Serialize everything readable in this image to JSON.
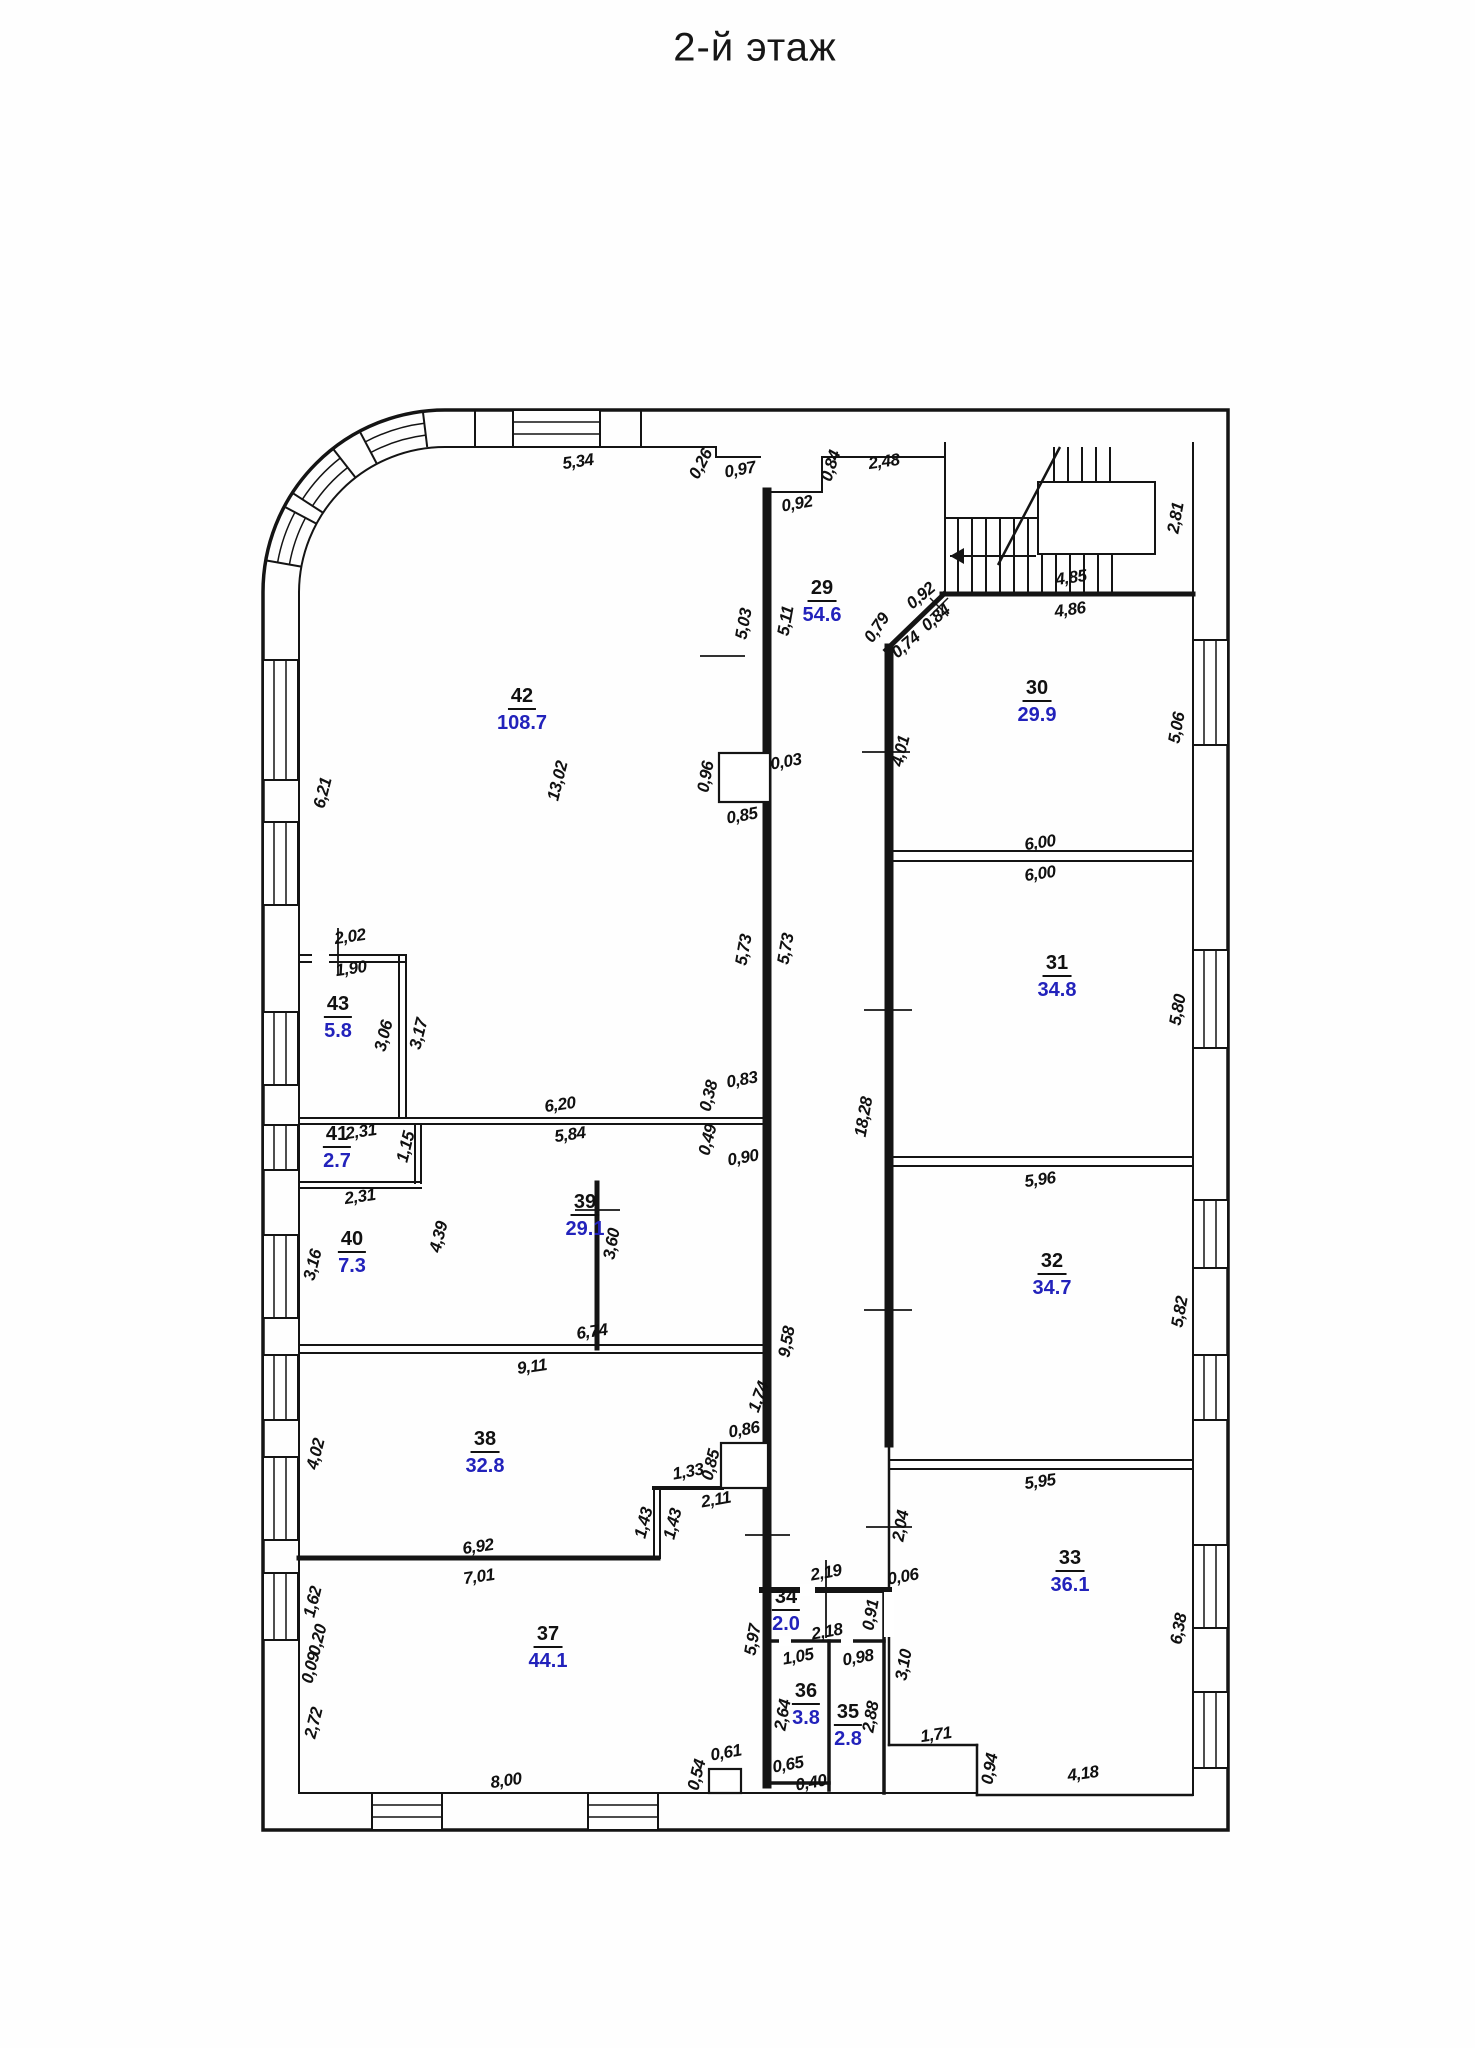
{
  "title": "2-й этаж",
  "colors": {
    "line": "#141414",
    "area_text": "#2222bb",
    "dim_text": "#101010"
  },
  "plan": {
    "rooms": [
      {
        "num": "29",
        "area": "54.6",
        "x": 822,
        "y": 592
      },
      {
        "num": "30",
        "area": "29.9",
        "x": 1037,
        "y": 692
      },
      {
        "num": "31",
        "area": "34.8",
        "x": 1057,
        "y": 967
      },
      {
        "num": "32",
        "area": "34.7",
        "x": 1052,
        "y": 1265
      },
      {
        "num": "33",
        "area": "36.1",
        "x": 1070,
        "y": 1562
      },
      {
        "num": "34",
        "area": "2.0",
        "x": 786,
        "y": 1601
      },
      {
        "num": "35",
        "area": "2.8",
        "x": 848,
        "y": 1716
      },
      {
        "num": "36",
        "area": "3.8",
        "x": 806,
        "y": 1695
      },
      {
        "num": "37",
        "area": "44.1",
        "x": 548,
        "y": 1638
      },
      {
        "num": "38",
        "area": "32.8",
        "x": 485,
        "y": 1443
      },
      {
        "num": "39",
        "area": "29.1",
        "x": 585,
        "y": 1206
      },
      {
        "num": "40",
        "area": "7.3",
        "x": 352,
        "y": 1243
      },
      {
        "num": "41",
        "area": "2.7",
        "x": 337,
        "y": 1138
      },
      {
        "num": "42",
        "area": "108.7",
        "x": 522,
        "y": 700
      },
      {
        "num": "43",
        "area": "5.8",
        "x": 338,
        "y": 1008
      }
    ],
    "dims": [
      {
        "t": "5,34",
        "x": 578,
        "y": 462,
        "r": -8
      },
      {
        "t": "0,26",
        "x": 701,
        "y": 464,
        "r": -62
      },
      {
        "t": "0,97",
        "x": 740,
        "y": 470,
        "r": -10
      },
      {
        "t": "0,92",
        "x": 797,
        "y": 504,
        "r": -10
      },
      {
        "t": "0,84",
        "x": 831,
        "y": 466,
        "r": -72
      },
      {
        "t": "2,48",
        "x": 884,
        "y": 462,
        "r": -8
      },
      {
        "t": "0,92",
        "x": 921,
        "y": 596,
        "r": -40
      },
      {
        "t": "0,79",
        "x": 877,
        "y": 628,
        "r": -56
      },
      {
        "t": "0,74",
        "x": 906,
        "y": 645,
        "r": -40
      },
      {
        "t": "0,84",
        "x": 936,
        "y": 618,
        "r": -40
      },
      {
        "t": "4,85",
        "x": 1071,
        "y": 578,
        "r": -8
      },
      {
        "t": "4,86",
        "x": 1070,
        "y": 610,
        "r": -8
      },
      {
        "t": "2,81",
        "x": 1176,
        "y": 518,
        "r": -80
      },
      {
        "t": "5,03",
        "x": 744,
        "y": 624,
        "r": -80
      },
      {
        "t": "5,11",
        "x": 786,
        "y": 621,
        "r": -80
      },
      {
        "t": "0,96",
        "x": 706,
        "y": 777,
        "r": -80
      },
      {
        "t": "0,03",
        "x": 786,
        "y": 762,
        "r": -10
      },
      {
        "t": "0,85",
        "x": 742,
        "y": 816,
        "r": -10
      },
      {
        "t": "6,21",
        "x": 323,
        "y": 793,
        "r": -76
      },
      {
        "t": "13,02",
        "x": 558,
        "y": 781,
        "r": -76
      },
      {
        "t": "4,01",
        "x": 901,
        "y": 751,
        "r": -76
      },
      {
        "t": "5,06",
        "x": 1177,
        "y": 728,
        "r": -80
      },
      {
        "t": "6,00",
        "x": 1040,
        "y": 843,
        "r": -8
      },
      {
        "t": "6,00",
        "x": 1040,
        "y": 874,
        "r": -8
      },
      {
        "t": "5,73",
        "x": 744,
        "y": 950,
        "r": -80
      },
      {
        "t": "5,73",
        "x": 786,
        "y": 949,
        "r": -80
      },
      {
        "t": "18,28",
        "x": 864,
        "y": 1117,
        "r": -80
      },
      {
        "t": "5,80",
        "x": 1178,
        "y": 1010,
        "r": -80
      },
      {
        "t": "2,02",
        "x": 350,
        "y": 937,
        "r": -8
      },
      {
        "t": "1,90",
        "x": 351,
        "y": 969,
        "r": -8
      },
      {
        "t": "3,06",
        "x": 384,
        "y": 1036,
        "r": -76
      },
      {
        "t": "3,17",
        "x": 419,
        "y": 1034,
        "r": -76
      },
      {
        "t": "6,20",
        "x": 560,
        "y": 1105,
        "r": -8
      },
      {
        "t": "5,84",
        "x": 570,
        "y": 1135,
        "r": -8
      },
      {
        "t": "0,83",
        "x": 742,
        "y": 1080,
        "r": -10
      },
      {
        "t": "0,38",
        "x": 709,
        "y": 1096,
        "r": -76
      },
      {
        "t": "0,49",
        "x": 708,
        "y": 1140,
        "r": -76
      },
      {
        "t": "0,90",
        "x": 743,
        "y": 1158,
        "r": -10
      },
      {
        "t": "2,31",
        "x": 361,
        "y": 1132,
        "r": -8
      },
      {
        "t": "1,15",
        "x": 406,
        "y": 1147,
        "r": -76
      },
      {
        "t": "2,31",
        "x": 360,
        "y": 1197,
        "r": -8
      },
      {
        "t": "3,16",
        "x": 313,
        "y": 1265,
        "r": -76
      },
      {
        "t": "4,39",
        "x": 439,
        "y": 1237,
        "r": -76
      },
      {
        "t": "5,96",
        "x": 1040,
        "y": 1180,
        "r": -8
      },
      {
        "t": "5,82",
        "x": 1180,
        "y": 1312,
        "r": -80
      },
      {
        "t": "9,11",
        "x": 532,
        "y": 1367,
        "r": -8
      },
      {
        "t": "6,74",
        "x": 592,
        "y": 1332,
        "r": -8
      },
      {
        "t": "9,58",
        "x": 787,
        "y": 1342,
        "r": -80
      },
      {
        "t": "3,60",
        "x": 612,
        "y": 1244,
        "r": -80
      },
      {
        "t": "1,74",
        "x": 759,
        "y": 1397,
        "r": -70
      },
      {
        "t": "0,86",
        "x": 744,
        "y": 1430,
        "r": -10
      },
      {
        "t": "0,85",
        "x": 711,
        "y": 1465,
        "r": -76
      },
      {
        "t": "1,33",
        "x": 688,
        "y": 1472,
        "r": -10
      },
      {
        "t": "2,11",
        "x": 716,
        "y": 1500,
        "r": -10
      },
      {
        "t": "1,43",
        "x": 644,
        "y": 1523,
        "r": -76
      },
      {
        "t": "1,43",
        "x": 673,
        "y": 1524,
        "r": -76
      },
      {
        "t": "4,02",
        "x": 316,
        "y": 1454,
        "r": -76
      },
      {
        "t": "6,92",
        "x": 478,
        "y": 1547,
        "r": -8
      },
      {
        "t": "7,01",
        "x": 479,
        "y": 1577,
        "r": -8
      },
      {
        "t": "1,62",
        "x": 313,
        "y": 1602,
        "r": -76
      },
      {
        "t": "0,20",
        "x": 318,
        "y": 1640,
        "r": -76
      },
      {
        "t": "0,09",
        "x": 311,
        "y": 1668,
        "r": -76
      },
      {
        "t": "2,72",
        "x": 314,
        "y": 1723,
        "r": -76
      },
      {
        "t": "8,00",
        "x": 506,
        "y": 1781,
        "r": -8
      },
      {
        "t": "0,61",
        "x": 726,
        "y": 1753,
        "r": -10
      },
      {
        "t": "0,54",
        "x": 697,
        "y": 1775,
        "r": -76
      },
      {
        "t": "2,19",
        "x": 826,
        "y": 1573,
        "r": -10
      },
      {
        "t": "2,04",
        "x": 901,
        "y": 1526,
        "r": -80
      },
      {
        "t": "0,06",
        "x": 903,
        "y": 1577,
        "r": -10
      },
      {
        "t": "2,18",
        "x": 827,
        "y": 1632,
        "r": -10
      },
      {
        "t": "0,91",
        "x": 871,
        "y": 1615,
        "r": -80
      },
      {
        "t": "5,97",
        "x": 753,
        "y": 1640,
        "r": -80
      },
      {
        "t": "1,05",
        "x": 798,
        "y": 1657,
        "r": -10
      },
      {
        "t": "0,98",
        "x": 858,
        "y": 1658,
        "r": -10
      },
      {
        "t": "3,10",
        "x": 904,
        "y": 1665,
        "r": -80
      },
      {
        "t": "2,64",
        "x": 783,
        "y": 1715,
        "r": -80
      },
      {
        "t": "2,88",
        "x": 871,
        "y": 1717,
        "r": -80
      },
      {
        "t": "0,65",
        "x": 788,
        "y": 1765,
        "r": -10
      },
      {
        "t": "0,40",
        "x": 811,
        "y": 1783,
        "r": -10
      },
      {
        "t": "1,71",
        "x": 936,
        "y": 1735,
        "r": -8
      },
      {
        "t": "0,94",
        "x": 990,
        "y": 1769,
        "r": -80
      },
      {
        "t": "4,18",
        "x": 1083,
        "y": 1774,
        "r": -8
      },
      {
        "t": "5,95",
        "x": 1040,
        "y": 1482,
        "r": -8
      },
      {
        "t": "6,38",
        "x": 1179,
        "y": 1629,
        "r": -80
      }
    ]
  }
}
